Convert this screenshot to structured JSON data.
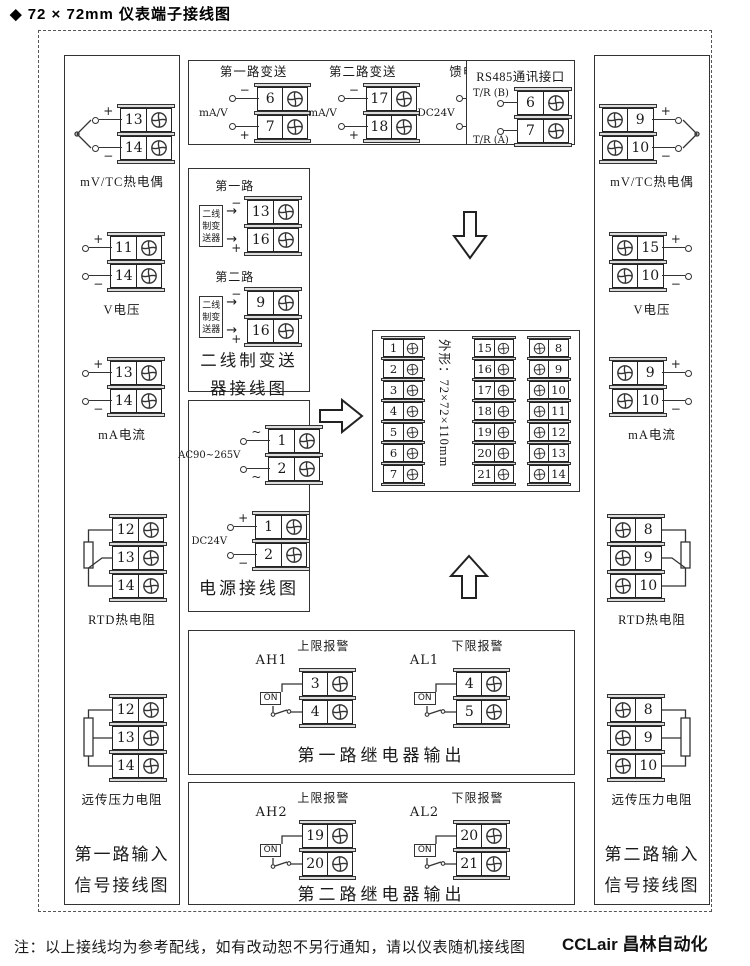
{
  "title": "◆ 72 × 72mm 仪表端子接线图",
  "footer_note": "注：以上接线均为参考配线，如有改动恕不另行通知，请以仪表随机接线图",
  "watermark": "CCLair 昌林自动化",
  "colors": {
    "line": "#222222",
    "terminal_cap": "#dcdcdc",
    "background": "#ffffff"
  },
  "top_box": {
    "groups": [
      {
        "title": "第一路变送",
        "side": "mA/V",
        "signs": [
          "−",
          "+"
        ],
        "terminals": [
          6,
          7
        ]
      },
      {
        "title": "第二路变送",
        "side": "mA/V",
        "signs": [
          "−",
          "+"
        ],
        "terminals": [
          17,
          18
        ]
      },
      {
        "title": "馈电输出",
        "side": "DC24V",
        "signs": [
          "−",
          "+"
        ],
        "terminals": [
          14,
          16
        ]
      }
    ]
  },
  "rs485_box": {
    "title": "RS485通讯接口",
    "rows": [
      {
        "label": "T/R (B)"
      },
      {
        "label": "T/R (A)"
      }
    ],
    "terminals": [
      6,
      7
    ]
  },
  "transmitter_box": {
    "sections": [
      {
        "title": "第一路",
        "device": "二线制变送器",
        "signs": [
          "−",
          "+"
        ],
        "terminals": [
          13,
          16
        ]
      },
      {
        "title": "第二路",
        "device": "二线制变送器",
        "signs": [
          "−",
          "+"
        ],
        "terminals": [
          9,
          16
        ]
      }
    ],
    "footer_line1": "二线制变送",
    "footer_line2": "器接线图"
  },
  "power_box": {
    "sections": [
      {
        "label": "AC90~265V",
        "signs": [
          "~",
          "~"
        ],
        "terminals": [
          1,
          2
        ]
      },
      {
        "label": "DC24V",
        "signs": [
          "+",
          "−"
        ],
        "terminals": [
          1,
          2
        ]
      }
    ],
    "footer": "电源接线图"
  },
  "center_block": {
    "dimension": "外形：72×72×110mm",
    "col1": [
      1,
      2,
      3,
      4,
      5,
      6,
      7
    ],
    "col2": [
      15,
      16,
      17,
      18,
      19,
      20,
      21
    ],
    "col3": [
      8,
      9,
      10,
      11,
      12,
      13,
      14
    ]
  },
  "relay_box1": {
    "sections": [
      {
        "title": "上限报警",
        "tag": "AH1",
        "switch_label": "ON",
        "terminals": [
          3,
          4
        ]
      },
      {
        "title": "下限报警",
        "tag": "AL1",
        "switch_label": "ON",
        "terminals": [
          4,
          5
        ]
      }
    ],
    "footer": "第一路继电器输出"
  },
  "relay_box2": {
    "sections": [
      {
        "title": "上限报警",
        "tag": "AH2",
        "switch_label": "ON",
        "terminals": [
          19,
          20
        ]
      },
      {
        "title": "下限报警",
        "tag": "AL2",
        "switch_label": "ON",
        "terminals": [
          20,
          21
        ]
      }
    ],
    "footer": "第二路继电器输出"
  },
  "left_column": {
    "groups": [
      {
        "label": "mV/TC热电偶",
        "signs": [
          "+",
          "−"
        ],
        "terminals": [
          13,
          14
        ]
      },
      {
        "label": "V电压",
        "signs": [
          "+",
          "−"
        ],
        "terminals": [
          11,
          14
        ]
      },
      {
        "label": "mA电流",
        "signs": [
          "+",
          "−"
        ],
        "terminals": [
          13,
          14
        ]
      },
      {
        "label": "RTD热电阻",
        "terminals": [
          12,
          13,
          14
        ]
      },
      {
        "label": "远传压力电阻",
        "terminals": [
          12,
          13,
          14
        ]
      }
    ],
    "footer_line1": "第一路输入",
    "footer_line2": "信号接线图"
  },
  "right_column": {
    "groups": [
      {
        "label": "mV/TC热电偶",
        "signs": [
          "+",
          "−"
        ],
        "terminals": [
          9,
          10
        ]
      },
      {
        "label": "V电压",
        "signs": [
          "+",
          "−"
        ],
        "terminals": [
          15,
          10
        ]
      },
      {
        "label": "mA电流",
        "signs": [
          "+",
          "−"
        ],
        "terminals": [
          9,
          10
        ]
      },
      {
        "label": "RTD热电阻",
        "terminals": [
          8,
          9,
          10
        ]
      },
      {
        "label": "远传压力电阻",
        "terminals": [
          8,
          9,
          10
        ]
      }
    ],
    "footer_line1": "第二路输入",
    "footer_line2": "信号接线图"
  }
}
